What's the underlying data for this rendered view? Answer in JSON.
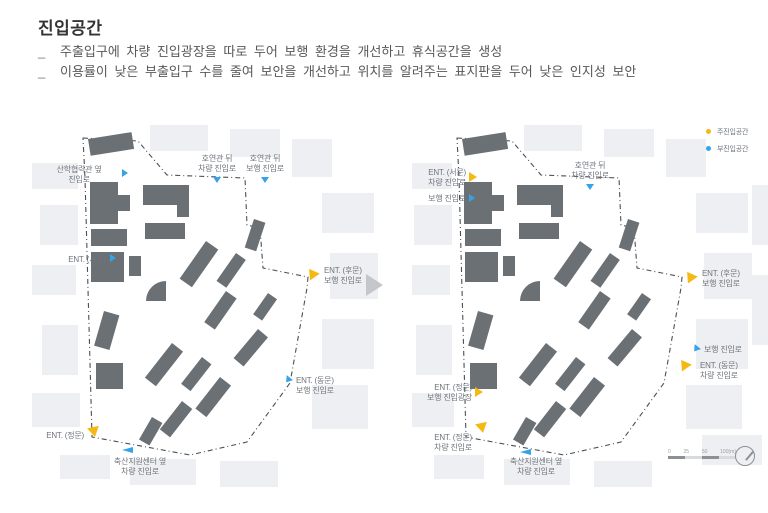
{
  "title": "진입공간",
  "bullets": [
    {
      "marker": "_",
      "text": "주출입구에 차량 진입광장을 따로 두어 보행 환경을 개선하고 휴식공간을 생성"
    },
    {
      "marker": "_",
      "text": "이용률이 낮은 부출입구 수를 줄여 보안을 개선하고 위치를 알려주는 표지판을 두어 낮은 인지성 보안"
    }
  ],
  "legend": {
    "items": [
      {
        "label": "주진입공간",
        "color": "#F5B914"
      },
      {
        "label": "부진입공간",
        "color": "#35A3E8"
      }
    ]
  },
  "maps": {
    "left": {
      "markers": [
        {
          "label": "산학협력관 옆\n진입로",
          "type": "sub"
        },
        {
          "label": "호연관 뒤\n차량 진입로",
          "type": "sub"
        },
        {
          "label": "호연관 뒤\n보행 진입로",
          "type": "sub"
        },
        {
          "label": "ENT. (서문)",
          "type": "sub"
        },
        {
          "label": "ENT. (후문)\n보행 진입로",
          "type": "main"
        },
        {
          "label": "ENT. (동문)\n보행 진입로",
          "type": "sub"
        },
        {
          "label": "ENT. (정문)",
          "type": "main"
        },
        {
          "label": "축산지원센터 옆\n차량 진입로",
          "type": "sub"
        }
      ]
    },
    "right": {
      "markers": [
        {
          "label": "ENT. (서문)\n차량 진입로",
          "type": "main"
        },
        {
          "label": "보행 진입로",
          "type": "sub"
        },
        {
          "label": "호연관 뒤\n차량 진입로",
          "type": "sub"
        },
        {
          "label": "ENT. (후문)\n보행 진입로",
          "type": "main"
        },
        {
          "label": "보행 진입로",
          "type": "sub"
        },
        {
          "label": "ENT. (동문)\n차량 진입로",
          "type": "main"
        },
        {
          "label": "ENT. (정문)\n보행 진입광장",
          "type": "main"
        },
        {
          "label": "ENT. (정문)\n차량 진입로",
          "type": "main"
        },
        {
          "label": "축산지원센터 옆\n차량 진입로",
          "type": "sub"
        }
      ]
    }
  },
  "scalebar": {
    "labels": [
      "0",
      "25",
      "50",
      "100(m)"
    ]
  },
  "colors": {
    "primary_entry": "#F5B914",
    "sub_entry": "#35A3E8",
    "building": "#6B7075",
    "boundary": "#4A4F55",
    "context_block": "#EDEFF2"
  }
}
